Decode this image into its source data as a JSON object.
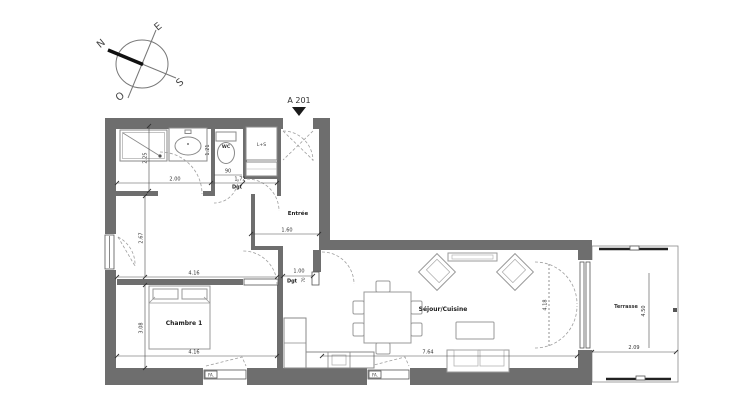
{
  "plan": {
    "unit_label": "A 201",
    "compass": {
      "n": "N",
      "e": "E",
      "s": "S",
      "o": "O"
    },
    "rooms": {
      "entree": "Entrée",
      "chambre": "Chambre 1",
      "sejour": "Séjour/Cuisine",
      "terrasse": "Terrasse",
      "wc": "WC",
      "dgt_hall": "Dgt",
      "dgt_passage": "Dgt",
      "closet": "L+S"
    },
    "windows": {
      "chambre_window": "FA.",
      "sejour_window": "FA."
    },
    "dimensions": {
      "bath_depth": "2.25",
      "bath_width": "2.00",
      "wc_width": "90",
      "wc_depth": "1.21",
      "hall_length": "1.72",
      "entree_width": "1.60",
      "upper_room_depth": "2.67",
      "upper_room_width": "4.16",
      "passage_width": "1.00",
      "passage_depth": "70",
      "chambre_depth": "3.08",
      "chambre_width": "4.16",
      "sejour_width": "7.64",
      "sejour_door_height": "4.18",
      "terrasse_depth": "4.50",
      "terrasse_width": "2.09"
    },
    "colors": {
      "wall": "#6e6e6e",
      "lines": "#555555",
      "dashes": "#9f9f9f",
      "background": "#ffffff"
    }
  }
}
